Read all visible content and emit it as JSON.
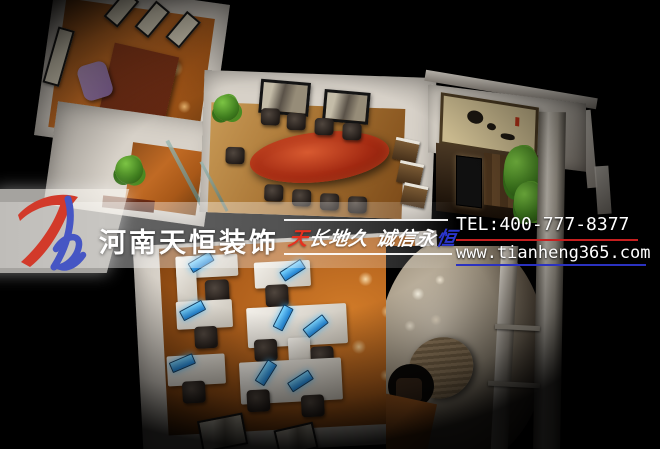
{
  "brand": {
    "logo_text": "Th",
    "logo_red": "#d23a2a",
    "logo_blue": "#4656c4",
    "company_name": "河南天恒装饰"
  },
  "slogan": {
    "red_char": "天",
    "white_text": "长地久 诚信永",
    "blue_char": "恒"
  },
  "contact": {
    "tel": "TEL:400-777-8377",
    "website": "www.tianheng365.com",
    "tel_underline_color": "#c61f1f",
    "website_underline_color": "#2b32c0"
  },
  "palette": {
    "background": "#000000",
    "wall": "#d7d1c8",
    "wood_floor": "#b0601c",
    "conference_table": "#a32a12",
    "monitor_glow": "#35a8ec",
    "reception_wall": "#d8cdbb"
  }
}
